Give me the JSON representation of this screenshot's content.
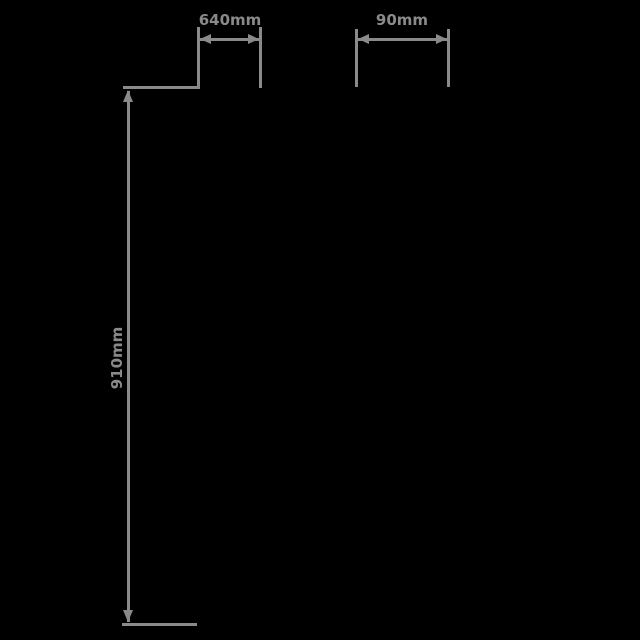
{
  "canvas": {
    "background_color": "#000000",
    "line_color": "#8a8a8a"
  },
  "dimensions": {
    "width_left": {
      "label": "640mm"
    },
    "width_right": {
      "label": "90mm"
    },
    "height": {
      "label": "910mm"
    }
  }
}
